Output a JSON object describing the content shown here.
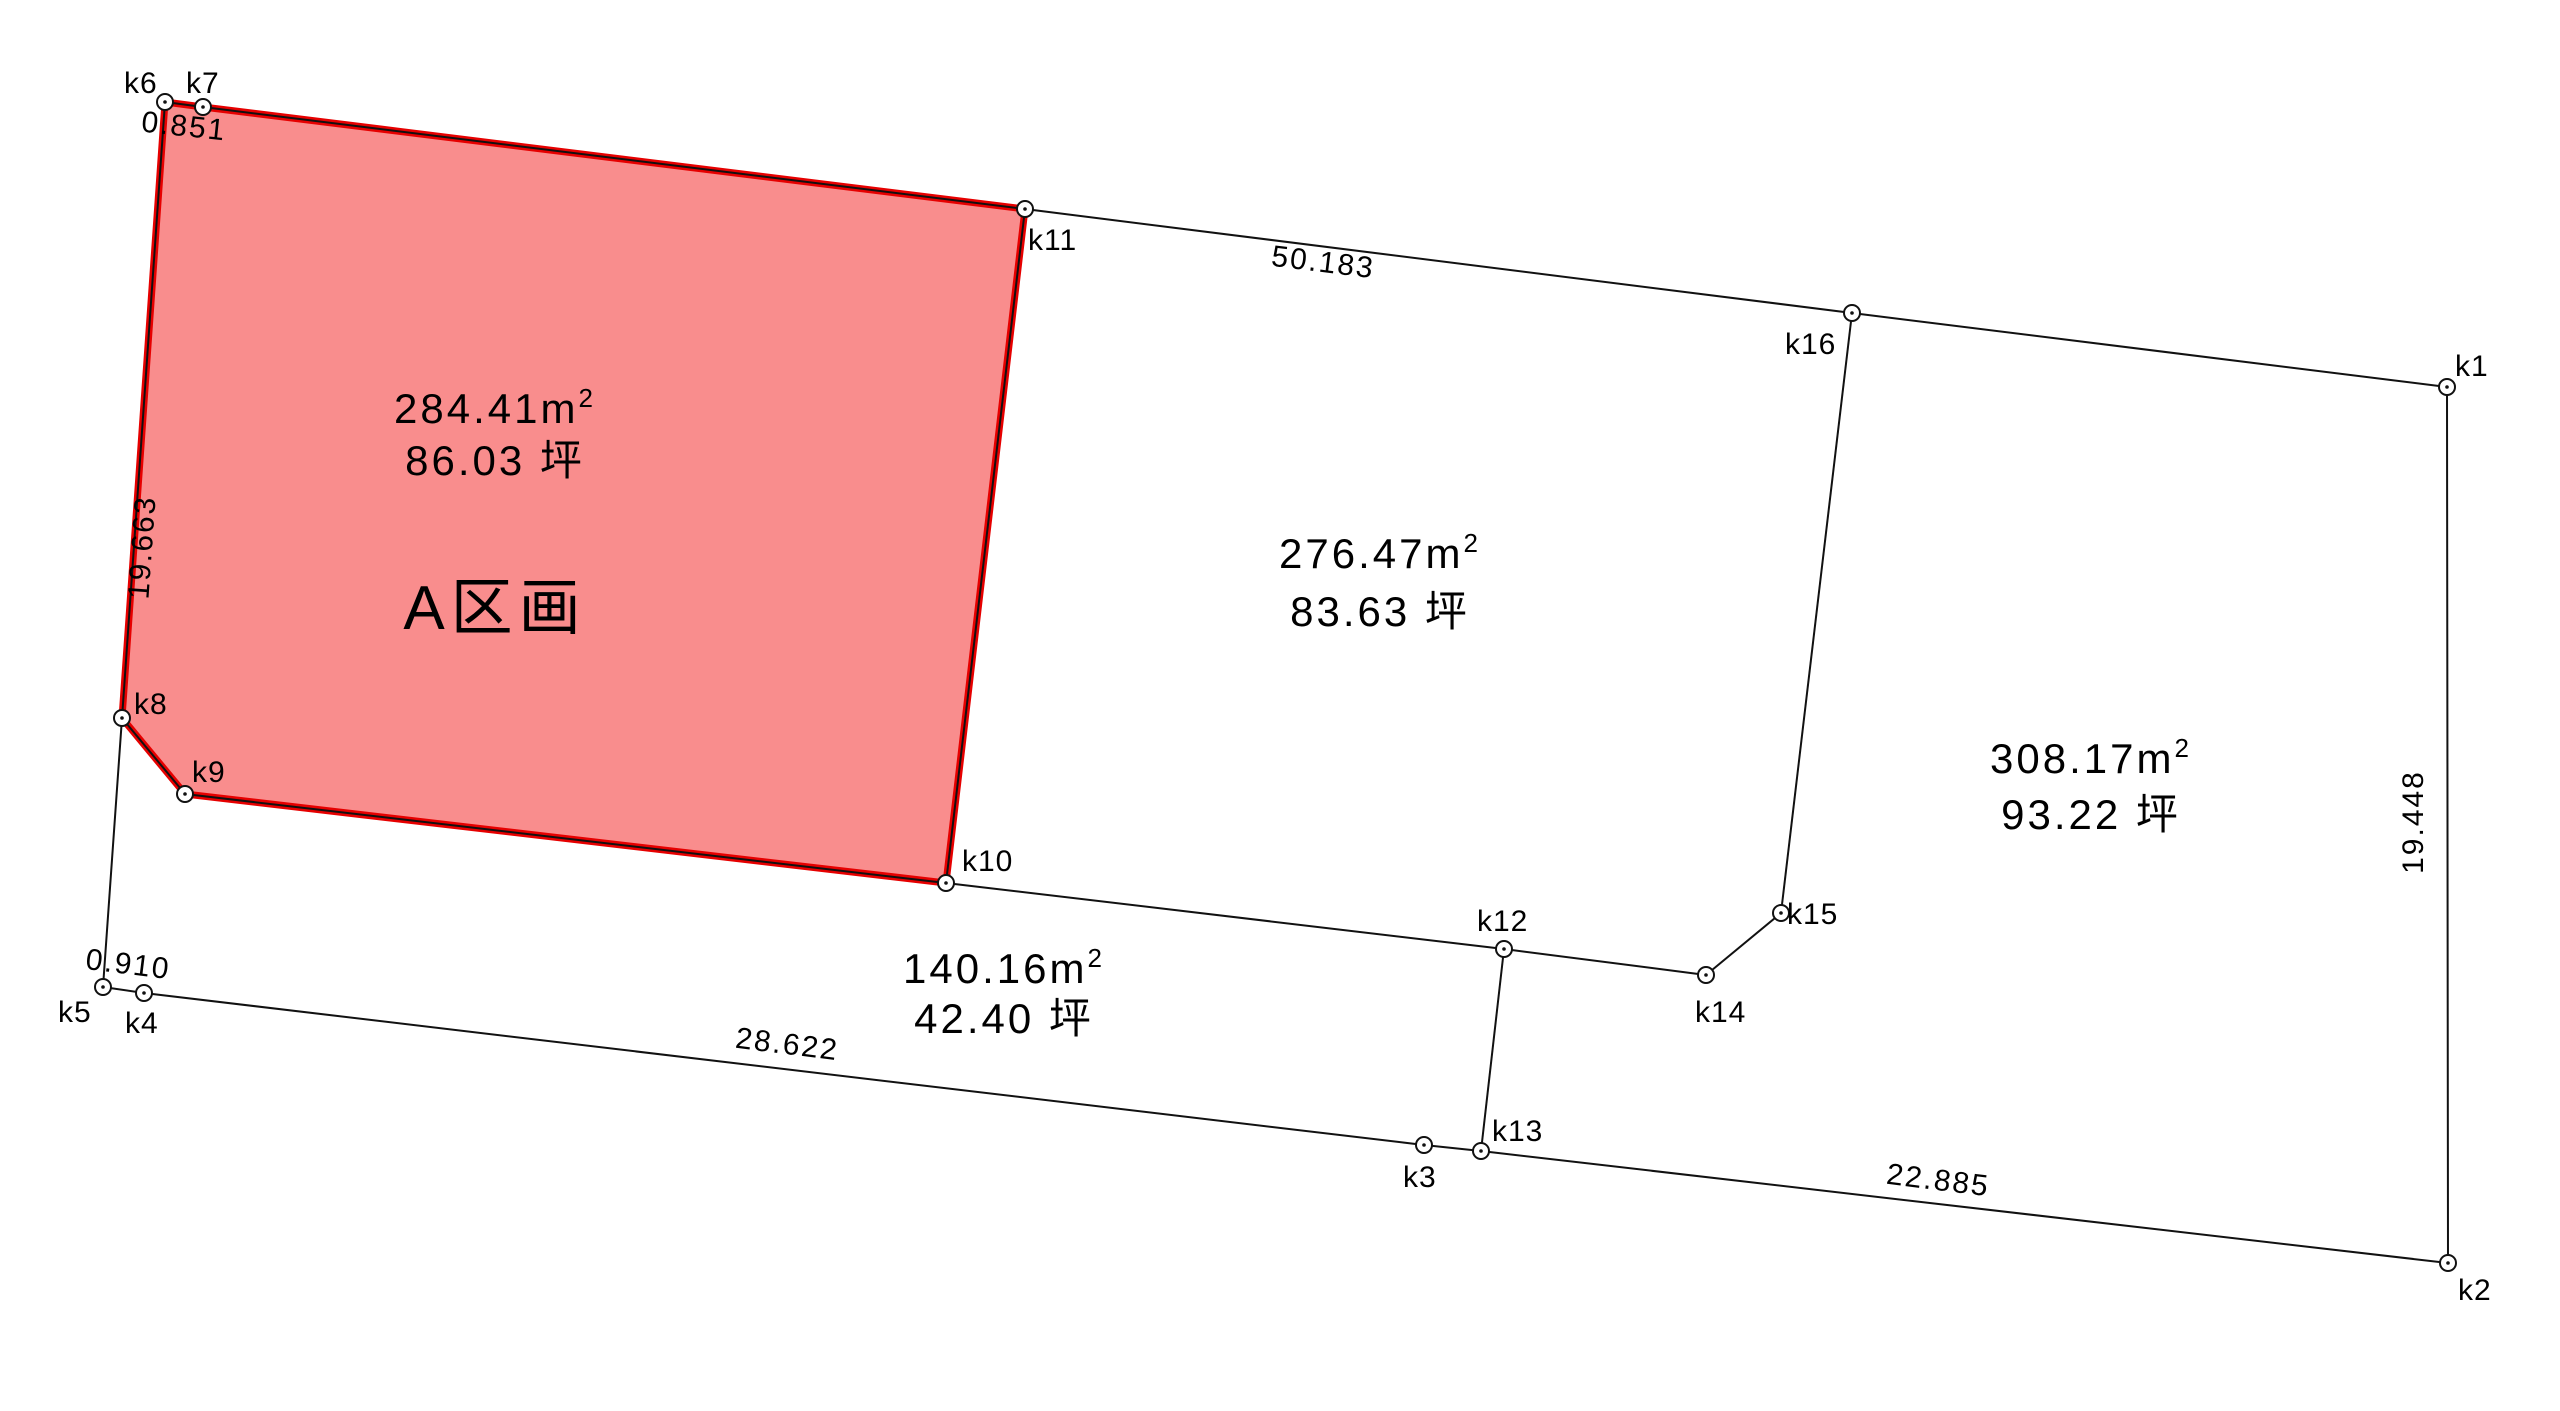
{
  "canvas": {
    "width": 2560,
    "height": 1411,
    "background": "#ffffff"
  },
  "colors": {
    "boundary_line": "#111111",
    "highlight_fill": "#f98d8d",
    "highlight_stroke": "#e60000",
    "text": "#000000",
    "marker_fill": "#ffffff"
  },
  "points": [
    {
      "id": "k1",
      "x": 2447,
      "y": 387,
      "label": "k1",
      "lx": 2455,
      "ly": 376
    },
    {
      "id": "k2",
      "x": 2448,
      "y": 1263,
      "label": "k2",
      "lx": 2458,
      "ly": 1300
    },
    {
      "id": "k3",
      "x": 1424,
      "y": 1145,
      "label": "k3",
      "lx": 1403,
      "ly": 1187
    },
    {
      "id": "k4",
      "x": 144,
      "y": 993,
      "label": "k4",
      "lx": 125,
      "ly": 1033
    },
    {
      "id": "k5",
      "x": 103,
      "y": 987,
      "label": "k5",
      "lx": 58,
      "ly": 1022
    },
    {
      "id": "k6",
      "x": 165,
      "y": 102,
      "label": "k6",
      "lx": 124,
      "ly": 93
    },
    {
      "id": "k7",
      "x": 203,
      "y": 107,
      "label": "k7",
      "lx": 186,
      "ly": 93
    },
    {
      "id": "k8",
      "x": 122,
      "y": 718,
      "label": "k8",
      "lx": 134,
      "ly": 714
    },
    {
      "id": "k9",
      "x": 185,
      "y": 794,
      "label": "k9",
      "lx": 192,
      "ly": 782
    },
    {
      "id": "k10",
      "x": 946,
      "y": 883,
      "label": "k10",
      "lx": 962,
      "ly": 871
    },
    {
      "id": "k11",
      "x": 1025,
      "y": 209,
      "label": "k11",
      "lx": 1028,
      "ly": 250
    },
    {
      "id": "k12",
      "x": 1504,
      "y": 949,
      "label": "k12",
      "lx": 1477,
      "ly": 931
    },
    {
      "id": "k13",
      "x": 1481,
      "y": 1151,
      "label": "k13",
      "lx": 1492,
      "ly": 1141
    },
    {
      "id": "k14",
      "x": 1706,
      "y": 975,
      "label": "k14",
      "lx": 1695,
      "ly": 1022
    },
    {
      "id": "k15",
      "x": 1781,
      "y": 913,
      "label": "k15",
      "lx": 1787,
      "ly": 924
    },
    {
      "id": "k16",
      "x": 1852,
      "y": 313,
      "label": "k16",
      "lx": 1785,
      "ly": 354
    }
  ],
  "outer_boundary": [
    "k6",
    "k7",
    "k11",
    "k16",
    "k1",
    "k2",
    "k13",
    "k3",
    "k4",
    "k5",
    "k8"
  ],
  "inner_lines": [
    [
      "k8",
      "k9"
    ],
    [
      "k9",
      "k10"
    ],
    [
      "k11",
      "k10"
    ],
    [
      "k10",
      "k12"
    ],
    [
      "k12",
      "k13"
    ],
    [
      "k12",
      "k14"
    ],
    [
      "k14",
      "k15"
    ],
    [
      "k15",
      "k16"
    ]
  ],
  "highlight_parcel": {
    "name": "A区画",
    "vertices": [
      "k6",
      "k7",
      "k11",
      "k10",
      "k9",
      "k8"
    ],
    "stroke_width": 7
  },
  "measurements": [
    {
      "text": "0.851",
      "x": 183,
      "y": 136,
      "rotate": 6
    },
    {
      "text": "19.663",
      "x": 152,
      "y": 548,
      "rotate": -86
    },
    {
      "text": "50.183",
      "x": 1322,
      "y": 272,
      "rotate": 7
    },
    {
      "text": "0.910",
      "x": 127,
      "y": 974,
      "rotate": 7
    },
    {
      "text": "28.622",
      "x": 786,
      "y": 1054,
      "rotate": 7
    },
    {
      "text": "22.885",
      "x": 1937,
      "y": 1190,
      "rotate": 7
    },
    {
      "text": "19.448",
      "x": 2423,
      "y": 822,
      "rotate": -90
    }
  ],
  "parcels": [
    {
      "id": "A",
      "name": "A区画",
      "area_m2": "284.41",
      "area_tsubo": "86.03",
      "tsubo_unit": "坪",
      "cx": 495,
      "m2_y": 423,
      "tsubo_y": 475,
      "name_y": 629
    },
    {
      "id": "B",
      "name": "",
      "area_m2": "276.47",
      "area_tsubo": "83.63",
      "tsubo_unit": "坪",
      "cx": 1380,
      "m2_y": 568,
      "tsubo_y": 626,
      "name_y": null
    },
    {
      "id": "C",
      "name": "",
      "area_m2": "308.17",
      "area_tsubo": "93.22",
      "tsubo_unit": "坪",
      "cx": 2091,
      "m2_y": 773,
      "tsubo_y": 829,
      "name_y": null
    },
    {
      "id": "D",
      "name": "",
      "area_m2": "140.16",
      "area_tsubo": "42.40",
      "tsubo_unit": "坪",
      "cx": 1004,
      "m2_y": 983,
      "tsubo_y": 1033,
      "name_y": null
    }
  ],
  "marker": {
    "radius": 8,
    "dot_radius": 1.8,
    "stroke_width": 2
  },
  "line_width": 2
}
